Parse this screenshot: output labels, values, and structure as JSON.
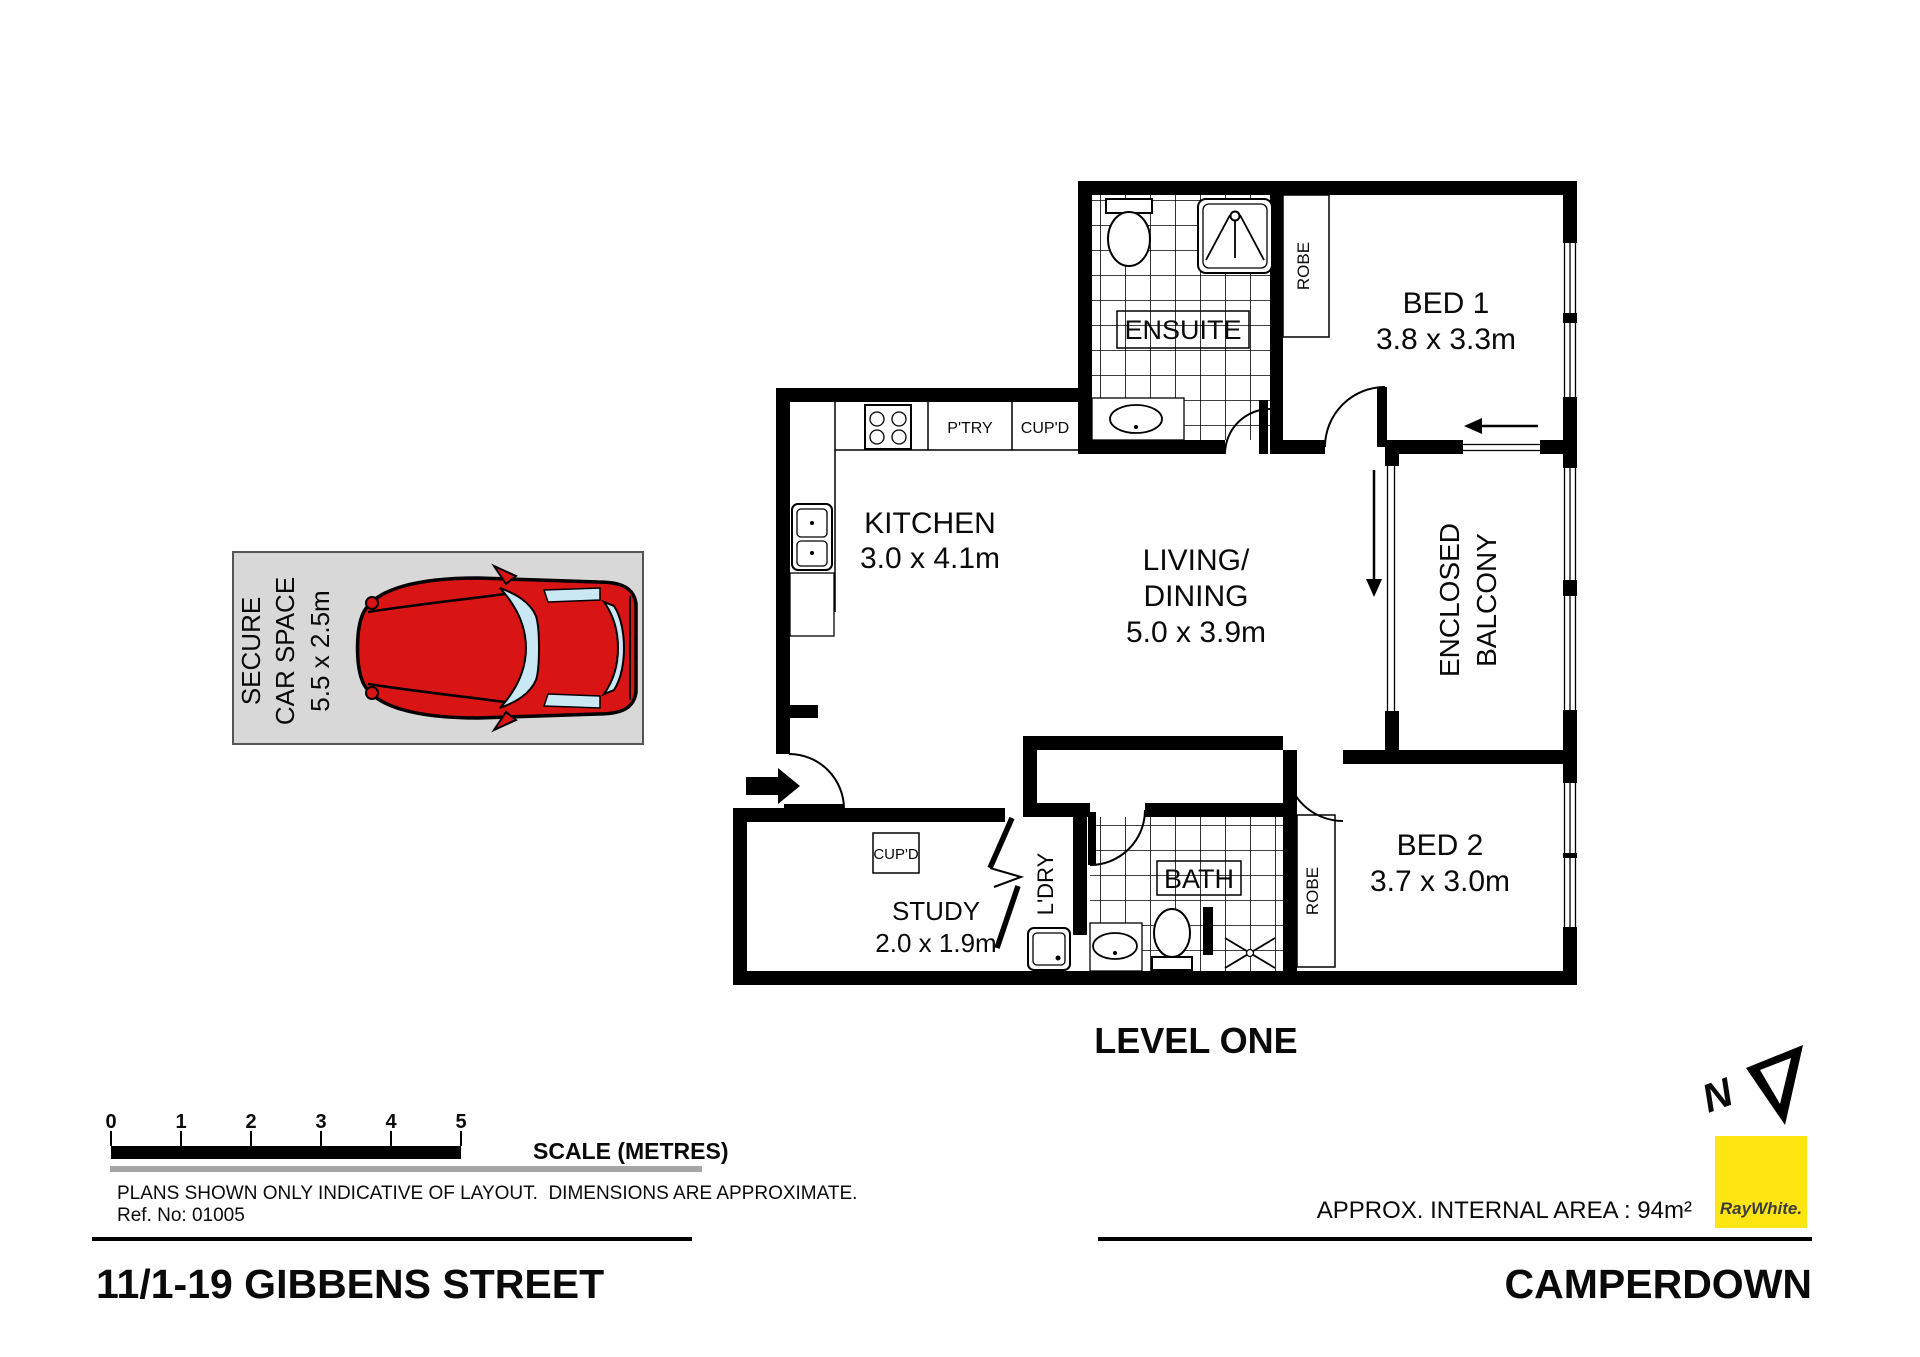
{
  "document": {
    "address": "11/1-19 GIBBENS STREET",
    "suburb": "CAMPERDOWN",
    "level_label": "LEVEL ONE",
    "approx_area": "APPROX. INTERNAL AREA : 94m²",
    "disclaimer": "PLANS SHOWN ONLY INDICATIVE OF LAYOUT.  DIMENSIONS ARE APPROXIMATE.",
    "ref_no": "Ref. No: 01005",
    "north_letter": "N"
  },
  "brand": {
    "name": "RayWhite.",
    "color": "#ffe512"
  },
  "scale_bar": {
    "label": "SCALE (METRES)",
    "ticks": [
      "0",
      "1",
      "2",
      "3",
      "4",
      "5"
    ]
  },
  "rooms": {
    "bed1": {
      "name": "BED 1",
      "dims": "3.8 x 3.3m"
    },
    "bed2": {
      "name": "BED 2",
      "dims": "3.7 x 3.0m"
    },
    "kitchen": {
      "name": "KITCHEN",
      "dims": "3.0 x 4.1m"
    },
    "living": {
      "line1": "LIVING/",
      "line2": "DINING",
      "dims": "5.0 x 3.9m"
    },
    "study": {
      "name": "STUDY",
      "dims": "2.0 x 1.9m"
    },
    "ensuite": {
      "name": "ENSUITE"
    },
    "bath": {
      "name": "BATH"
    },
    "laundry": {
      "name": "L'DRY"
    },
    "balcony": {
      "line1": "ENCLOSED",
      "line2": "BALCONY"
    },
    "robe1": {
      "name": "ROBE"
    },
    "robe2": {
      "name": "ROBE"
    },
    "pantry": {
      "name": "P'TRY"
    },
    "cupboard_kitchen": {
      "name": "CUP'D"
    },
    "cupboard_hall": {
      "name": "CUP'D"
    }
  },
  "car_space": {
    "line1": "SECURE",
    "line2": "CAR SPACE",
    "dims": "5.5 x 2.5m",
    "car_color": "#d81414"
  }
}
